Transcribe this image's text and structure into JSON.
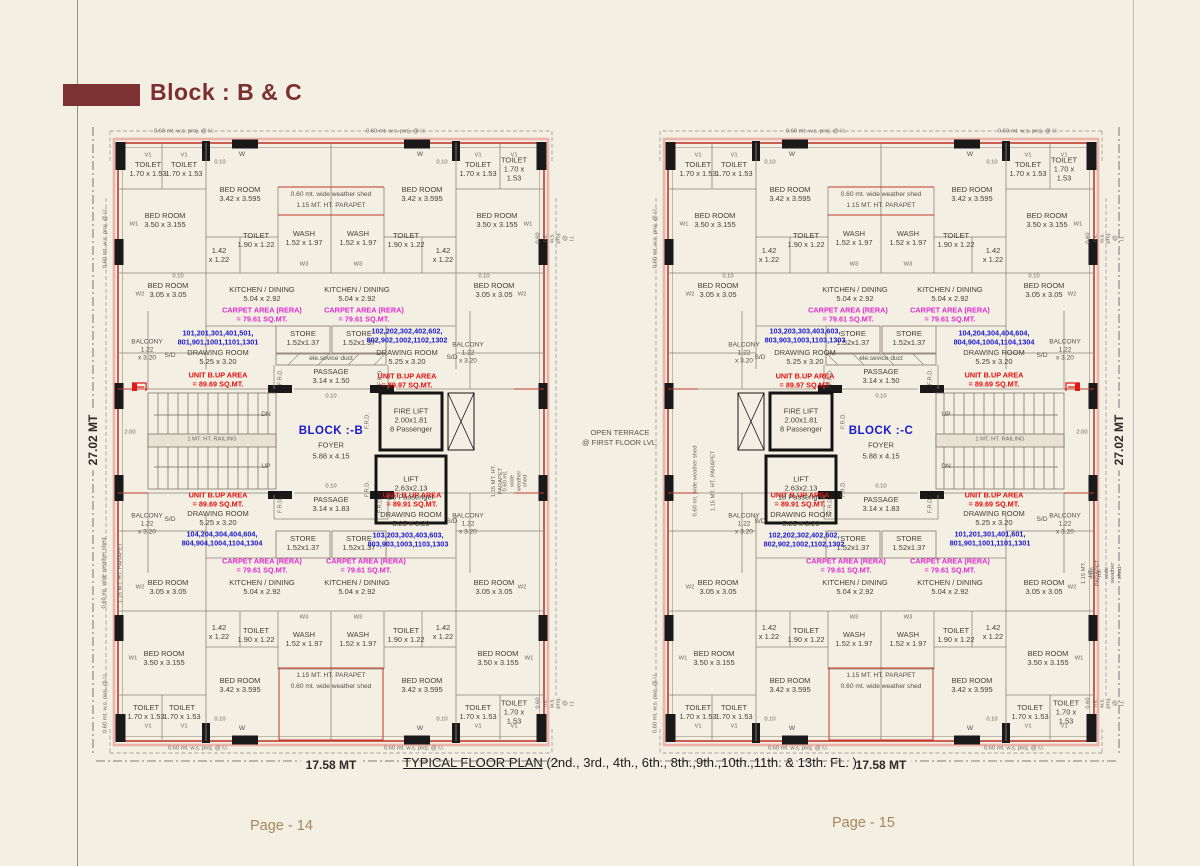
{
  "header": {
    "title": "Block : B & C",
    "accent_color": "#7d3333"
  },
  "footer": {
    "caption_main": "TYPICAL FLOOR PLAN",
    "caption_floors": " (2nd., 3rd., 4th., 6th., 8th.,9th.,10th.,11th. & 13th. FL. )"
  },
  "center_note": {
    "line1": "OPEN TERRACE",
    "line2": "@ FIRST FLOOR LVL."
  },
  "colors": {
    "background": "#f3efe2",
    "exterior_wall": "#c0392b",
    "wall_fill": "#191919",
    "unit_numbers": "#1818cf",
    "unit_area": "#e01010",
    "carpet_area": "#e22ad2",
    "title": "#7c2f2f",
    "page_number": "#a8865c"
  },
  "plans": [
    {
      "id": "planB",
      "name": "floor-plan-block-b",
      "mirrored": false,
      "page_label": "Page - 14",
      "slots": {
        "block": "BLOCK :-B",
        "u_tl": "101,201,301,401,501,\n801,901,1001,1101,1301",
        "u_tr": "102,202,302,402,602,\n802,902,1002,1102,1302",
        "u_bl": "104,204,304,404,604,\n804,904,1004,1104,1304",
        "u_br": "103,203,303,403,603,\n803,903,1003,1103,1303",
        "b_tl": "UNIT B.UP AREA\n= 89.69 SQ.MT.",
        "b_tr": "UNIT B.UP AREA\n= 89.97 SQ.MT.",
        "b_bl": "UNIT B.UP AREA\n= 89.69 SQ.MT.",
        "b_br": "UNIT B.UP AREA\n= 89.91 SQ.MT.",
        "st_top": "DN",
        "st_bot": "UP",
        "dim_h": "17.58 MT",
        "dim_v": "27.02 MT"
      }
    },
    {
      "id": "planC",
      "name": "floor-plan-block-c",
      "mirrored": true,
      "page_label": "Page - 15",
      "slots": {
        "block": "BLOCK :-C",
        "u_tl": "104,204,304,404,604,\n804,904,1004,1104,1304",
        "u_tr": "103,203,303,403,603,\n803,903,1003,1103,1303",
        "u_bl": "101,201,301,401,601,\n801,901,1001,1101,1301",
        "u_br": "102,202,302,402,602,\n802,902,1002,1102,1302",
        "b_tl": "UNIT B.UP AREA\n= 89.69 SQ.MT.",
        "b_tr": "UNIT B.UP AREA\n= 89.97 SQ.MT.",
        "b_bl": "UNIT B.UP AREA\n= 89.69 SQ.MT.",
        "b_br": "UNIT B.UP AREA\n= 89.91 SQ.MT.",
        "st_top": "UP",
        "st_bot": "DN",
        "dim_h": "17.58 MT",
        "dim_v": "27.02 MT"
      }
    }
  ],
  "plan_labels": [
    {
      "n": "toilet-room-label",
      "t": "TOILET\n1.70 x 1.53",
      "c": "rm",
      "pts": [
        [
          30,
          27
        ],
        [
          66,
          27
        ],
        [
          360,
          27
        ],
        [
          396,
          27
        ],
        [
          28,
          570
        ],
        [
          64,
          570
        ],
        [
          360,
          570
        ],
        [
          396,
          570
        ]
      ]
    },
    {
      "n": "bedroom-label",
      "t": "BED ROOM\n3.42 x 3.595",
      "c": "rm",
      "pts": [
        [
          122,
          52
        ],
        [
          304,
          52
        ],
        [
          122,
          543
        ],
        [
          304,
          543
        ]
      ]
    },
    {
      "n": "bedroom-label",
      "t": "BED ROOM\n3.50 x 3.155",
      "c": "rm",
      "pts": [
        [
          47,
          78
        ],
        [
          379,
          78
        ],
        [
          46,
          516
        ],
        [
          380,
          516
        ]
      ]
    },
    {
      "n": "bedroom-label",
      "t": "BED ROOM\n3.05 x 3.05",
      "c": "rm",
      "pts": [
        [
          50,
          148
        ],
        [
          376,
          148
        ],
        [
          50,
          445
        ],
        [
          376,
          445
        ]
      ]
    },
    {
      "n": "toilet-room-label",
      "t": "TOILET\n1.90 x 1.22",
      "c": "rm",
      "pts": [
        [
          138,
          98
        ],
        [
          288,
          98
        ],
        [
          138,
          493
        ],
        [
          288,
          493
        ]
      ]
    },
    {
      "n": "dim-label",
      "t": "1.42\nx 1.22",
      "c": "rm",
      "pts": [
        [
          101,
          113
        ],
        [
          325,
          113
        ],
        [
          101,
          490
        ],
        [
          325,
          490
        ]
      ]
    },
    {
      "n": "wash-room-label",
      "t": "WASH\n1.52 x 1.97",
      "c": "rm",
      "pts": [
        [
          186,
          96
        ],
        [
          240,
          96
        ],
        [
          186,
          497
        ],
        [
          240,
          497
        ]
      ]
    },
    {
      "n": "kitchen-label",
      "t": "KITCHEN / DINING\n5.04 x 2.92",
      "c": "rm",
      "pts": [
        [
          144,
          152
        ],
        [
          239,
          152
        ],
        [
          144,
          445
        ],
        [
          239,
          445
        ]
      ]
    },
    {
      "n": "carpet-area-label",
      "t": "CARPET AREA (RERA)\n= 79.61 SQ.MT.",
      "c": "mag",
      "pts": [
        [
          144,
          172
        ],
        [
          246,
          172
        ],
        [
          144,
          423
        ],
        [
          248,
          423
        ]
      ]
    },
    {
      "n": "store-label",
      "t": "STORE\n1.52x1.37",
      "c": "rm",
      "pts": [
        [
          185,
          196
        ],
        [
          241,
          196
        ],
        [
          185,
          401
        ],
        [
          241,
          401
        ]
      ]
    },
    {
      "n": "service-duct-label",
      "t": "ele.sevice duct",
      "c": "sm",
      "pts": [
        [
          213,
          216
        ]
      ]
    },
    {
      "n": "drawing-room-label",
      "t": "DRAWING ROOM\n5.25 x 3.20",
      "c": "rm",
      "pts": [
        [
          100,
          215
        ],
        [
          289,
          215
        ],
        [
          100,
          376
        ],
        [
          293,
          377
        ]
      ]
    },
    {
      "n": "unit-numbers-label",
      "k": "u_tl",
      "c": "blue",
      "pts": [
        [
          100,
          195
        ]
      ]
    },
    {
      "n": "unit-numbers-label",
      "k": "u_tr",
      "c": "blue",
      "pts": [
        [
          289,
          193
        ]
      ]
    },
    {
      "n": "unit-numbers-label",
      "k": "u_bl",
      "c": "blue",
      "pts": [
        [
          104,
          396
        ]
      ]
    },
    {
      "n": "unit-numbers-label",
      "k": "u_br",
      "c": "blue",
      "pts": [
        [
          290,
          397
        ]
      ]
    },
    {
      "n": "unit-area-label",
      "k": "b_tl",
      "c": "red",
      "pts": [
        [
          100,
          237
        ]
      ]
    },
    {
      "n": "unit-area-label",
      "k": "b_tr",
      "c": "red",
      "pts": [
        [
          289,
          238
        ]
      ]
    },
    {
      "n": "unit-area-label",
      "k": "b_bl",
      "c": "red",
      "pts": [
        [
          100,
          357
        ]
      ]
    },
    {
      "n": "unit-area-label",
      "k": "b_br",
      "c": "red",
      "pts": [
        [
          294,
          357
        ]
      ]
    },
    {
      "n": "balcony-label",
      "t": "BALCONY\n1.22\nx 3.20",
      "c": "sm",
      "pts": [
        [
          29,
          207
        ],
        [
          350,
          210
        ],
        [
          29,
          381
        ],
        [
          350,
          381
        ]
      ]
    },
    {
      "n": "sliding-door-label",
      "t": "S/D",
      "c": "sm",
      "pts": [
        [
          52,
          213
        ],
        [
          334,
          215
        ],
        [
          52,
          377
        ],
        [
          334,
          379
        ]
      ]
    },
    {
      "n": "passage-label",
      "t": "PASSAGE\n3.14 x 1.50",
      "c": "rm",
      "pts": [
        [
          213,
          234
        ]
      ]
    },
    {
      "n": "passage-label",
      "t": "PASSAGE\n3.14 x 1.83",
      "c": "rm",
      "pts": [
        [
          213,
          362
        ]
      ]
    },
    {
      "n": "block-name-label",
      "k": "block",
      "c": "blk",
      "pts": [
        [
          213,
          289
        ]
      ]
    },
    {
      "n": "foyer-label",
      "t": "FOYER",
      "c": "rm",
      "pts": [
        [
          213,
          303
        ]
      ]
    },
    {
      "n": "foyer-dim-label",
      "t": "5.88 x 4.15",
      "c": "rm",
      "pts": [
        [
          213,
          314
        ]
      ]
    },
    {
      "n": "fire-lift-label",
      "t": "FIRE LIFT\n2.00x1.81\n8 Passenger",
      "c": "rm",
      "pts": [
        [
          293,
          278
        ]
      ]
    },
    {
      "n": "lift-label",
      "t": "LIFT\n2.63x2.13\n18 Passenger",
      "c": "rm",
      "pts": [
        [
          293,
          346
        ]
      ]
    },
    {
      "n": "stair-direction-label",
      "k": "st_top",
      "c": "sm",
      "pts": [
        [
          148,
          272
        ]
      ]
    },
    {
      "n": "stair-direction-label",
      "k": "st_bot",
      "c": "sm",
      "pts": [
        [
          148,
          324
        ]
      ]
    },
    {
      "n": "stair-dim-label",
      "t": "2.00",
      "c": "tiny",
      "pts": [
        [
          12,
          290
        ]
      ]
    },
    {
      "n": "railing-label",
      "t": "1 MT. HT. RAILING",
      "c": "tiny",
      "pts": [
        [
          94,
          297
        ]
      ]
    },
    {
      "n": "weather-shed-label",
      "t": "0.60 mt. wide weather shed",
      "c": "sm",
      "pts": [
        [
          213,
          52
        ],
        [
          213,
          544
        ]
      ]
    },
    {
      "n": "parapet-label",
      "t": "1.15 MT. HT. PARAPET",
      "c": "sm",
      "pts": [
        [
          213,
          63
        ],
        [
          213,
          533
        ]
      ]
    },
    {
      "n": "frd-label",
      "t": "F.R.D.",
      "c": "tiny",
      "r": 1,
      "pts": [
        [
          163,
          234
        ],
        [
          263,
          234
        ],
        [
          250,
          278
        ],
        [
          250,
          346
        ],
        [
          163,
          362
        ],
        [
          263,
          362
        ]
      ]
    },
    {
      "n": "window-label",
      "t": "W",
      "c": "sm",
      "pts": [
        [
          124,
          12
        ],
        [
          302,
          12
        ],
        [
          124,
          586
        ],
        [
          302,
          586
        ]
      ]
    },
    {
      "n": "vent-label",
      "t": "V1",
      "c": "tiny",
      "pts": [
        [
          30,
          13
        ],
        [
          66,
          13
        ],
        [
          360,
          13
        ],
        [
          396,
          13
        ],
        [
          30,
          584
        ],
        [
          66,
          584
        ],
        [
          360,
          584
        ],
        [
          396,
          584
        ]
      ]
    },
    {
      "n": "window-label",
      "t": "W1",
      "c": "tiny",
      "pts": [
        [
          16,
          82
        ],
        [
          410,
          82
        ],
        [
          15,
          516
        ],
        [
          411,
          516
        ]
      ]
    },
    {
      "n": "window-label",
      "t": "W2",
      "c": "tiny",
      "pts": [
        [
          22,
          152
        ],
        [
          404,
          152
        ],
        [
          22,
          445
        ],
        [
          404,
          445
        ]
      ]
    },
    {
      "n": "window-label",
      "t": "W3",
      "c": "tiny",
      "pts": [
        [
          186,
          122
        ],
        [
          240,
          122
        ],
        [
          186,
          475
        ],
        [
          240,
          475
        ]
      ]
    },
    {
      "n": "wall-dim-label",
      "t": "0.10",
      "c": "tiny",
      "pts": [
        [
          102,
          20
        ],
        [
          324,
          20
        ],
        [
          60,
          134
        ],
        [
          366,
          134
        ],
        [
          102,
          577
        ],
        [
          324,
          577
        ],
        [
          213,
          254
        ],
        [
          213,
          344
        ]
      ]
    },
    {
      "n": "projection-label",
      "t": "0.60 mt. w.s. proj. @ l.l.",
      "c": "tiny",
      "r": 1,
      "pts": [
        [
          -12,
          95
        ],
        [
          -12,
          560
        ],
        [
          438,
          95
        ],
        [
          438,
          560
        ]
      ]
    },
    {
      "n": "projection-label",
      "t": "0.60 mt. w.s. proj. @ l.l.",
      "c": "tiny",
      "pts": [
        [
          66,
          -11
        ],
        [
          278,
          -11
        ],
        [
          80,
          606
        ],
        [
          296,
          606
        ]
      ]
    },
    {
      "n": "parapet-label",
      "t": "1.15 MT. HT. PARAPET",
      "c": "tiny",
      "r": 1,
      "pts": [
        [
          3,
          430
        ],
        [
          380,
          338
        ]
      ]
    },
    {
      "n": "weather-shed-label",
      "t": "0.60 mt. wide weather shed",
      "c": "tiny",
      "r": 1,
      "pts": [
        [
          -13,
          430
        ],
        [
          398,
          338
        ]
      ]
    },
    {
      "n": "width-dimension-label",
      "k": "dim_h",
      "c": "dimh",
      "pts": [
        [
          213,
          622
        ]
      ]
    },
    {
      "n": "height-dimension-label",
      "k": "dim_v",
      "c": "dimh",
      "r": 1,
      "pts": [
        [
          -25,
          297
        ]
      ]
    }
  ]
}
